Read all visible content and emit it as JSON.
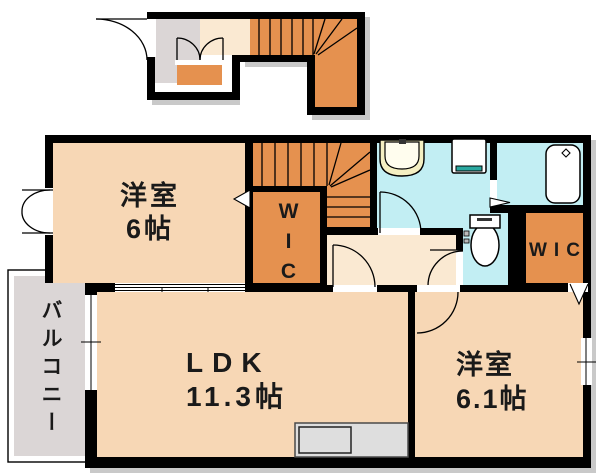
{
  "floorplan": {
    "bedroom1": {
      "line1": "洋室",
      "line2": "6帖"
    },
    "wic_hall": {
      "label": "WIC"
    },
    "ldk": {
      "line1": "LDK",
      "line2": "11.3帖"
    },
    "bedroom2": {
      "line1": "洋室",
      "line2": "6.1帖"
    },
    "wic_bedroom2": {
      "label": "WIC"
    },
    "balcony": {
      "label": "バルコニー"
    },
    "fixtures": [
      "stairs",
      "entry-door",
      "double-door",
      "washbasin",
      "washing-machine-pan",
      "bathtub",
      "toilet",
      "kitchen-counter",
      "sliding-window",
      "casement-window",
      "folding-closet-door"
    ]
  },
  "colors": {
    "wall": "#000000",
    "orange": "#E5914F",
    "peach": "#F7D7B5",
    "pale": "#FAE9D2",
    "gray": "#DBD6D6",
    "cyan": "#C2EEF3",
    "cream": "#F4EFC2",
    "teal": "#2AA8A0",
    "counter": "#DEDEDE",
    "shadow": "#C9C9C9"
  }
}
